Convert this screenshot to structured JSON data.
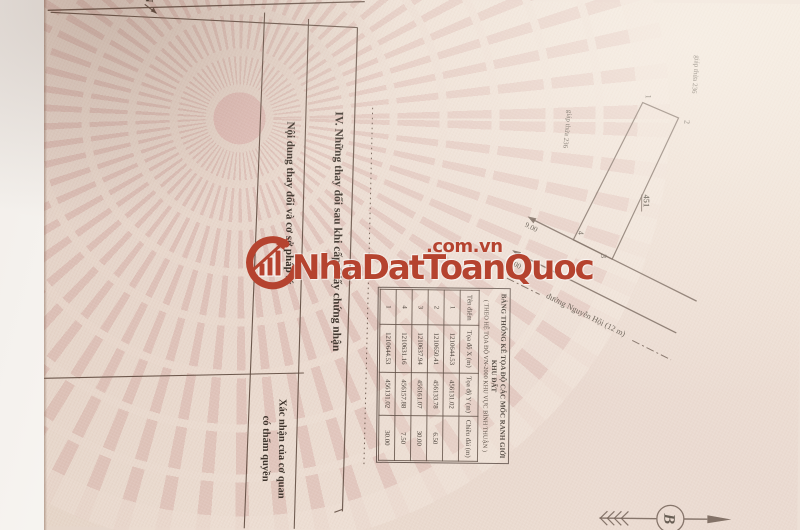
{
  "watermark": {
    "brand": "NhaDatToanQuoc",
    "domain": ".com.vn",
    "accent_red": "#b5432f"
  },
  "certificate": {
    "section_heading": "IV. Những thay đổi sau khi cấp Giấy chứng nhận",
    "column_left_header": "Nội dung thay đổi và cơ sở pháp lý",
    "column_right_header_line1": "Xác nhận của cơ quan",
    "column_right_header_line2": "có thẩm quyền"
  },
  "site_plan": {
    "north_letter": "N",
    "compass_letter": "B",
    "parcel_number": "451",
    "street_label": "đường Nguyễn Hội (12 m)",
    "adjacent_label_top": "giáp thửa 236",
    "adjacent_label_side": "giáp thửa 236",
    "dim_outer": "9.00",
    "dim_inner": "6.00",
    "point_labels": [
      "1",
      "2",
      "3",
      "4"
    ]
  },
  "coord_table": {
    "title_line1": "BẢNG THỐNG KÊ TỌA ĐỘ CÁC MỐC RANH GIỚI KHU ĐẤT",
    "title_line2": "( THEO HỆ TỌA ĐỘ VN-2000 KHU VỰC BÌNH THUẬN )",
    "headers": [
      "Tên điểm",
      "Tọa độ X (m)",
      "Tọa độ Y (m)",
      "Chiều dài (m)"
    ],
    "rows": [
      [
        "1",
        "1210644.53",
        "456131.02",
        ""
      ],
      [
        "2",
        "1210650.41",
        "456133.78",
        "6.50"
      ],
      [
        "3",
        "1210637.94",
        "456161.07",
        "30.00"
      ],
      [
        "4",
        "1210631.16",
        "456157.88",
        "7.50"
      ],
      [
        "1",
        "1210644.53",
        "456131.02",
        "30.00"
      ]
    ]
  }
}
